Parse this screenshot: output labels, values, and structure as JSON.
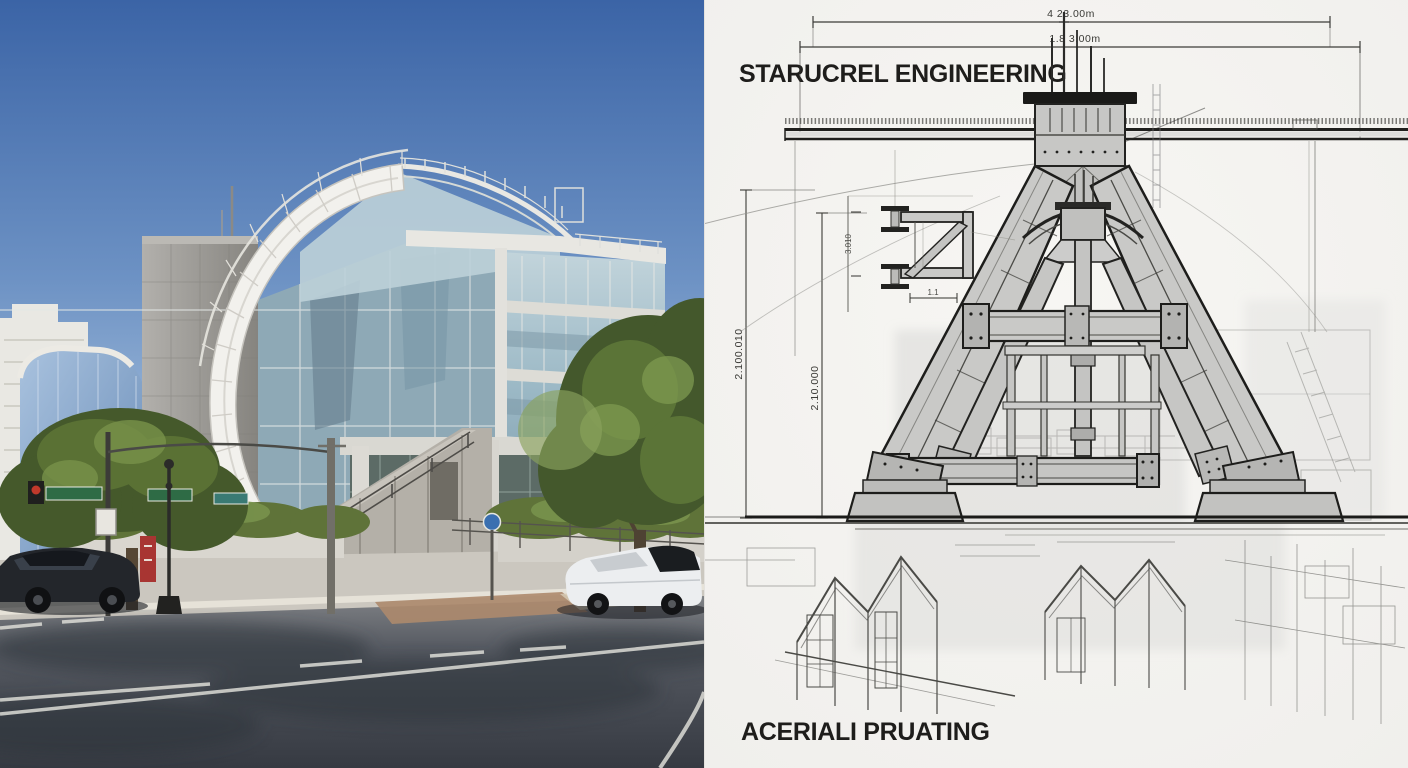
{
  "drawing": {
    "title": "STARUCREL ENGINEERING",
    "caption": "ACERIALI PRUATING",
    "dimensions": {
      "top_outer": "4 23.00m",
      "top_inner": "1.8 3.00m",
      "left_outer": "2.100.010",
      "left_inner": "2.10.000",
      "detail_height": "3.010",
      "detail_small": "1.1"
    },
    "colors": {
      "paper": "#f4f3f0",
      "ink": "#1d1d1b",
      "steel_fill": "#c9c9c7",
      "sketch": "#5a5a56"
    }
  },
  "photo": {
    "colors": {
      "sky_top": "#3b64a6",
      "sky_bottom": "#c3d4e6",
      "foliage_dark": "#45592b",
      "foliage_light": "#7a944e",
      "concrete_tower": "#9a9894",
      "glass_facade": "#9fbac6",
      "arc_white": "#f2f1ed",
      "road_dark": "#3a3e46",
      "sidewalk": "#cbc7bf",
      "street_sign_green": "#2e6b45",
      "banner_red": "#a83532",
      "car_white": "#eceef0",
      "car_dark": "#23262b",
      "brick_paving": "#ad8a6d"
    }
  }
}
